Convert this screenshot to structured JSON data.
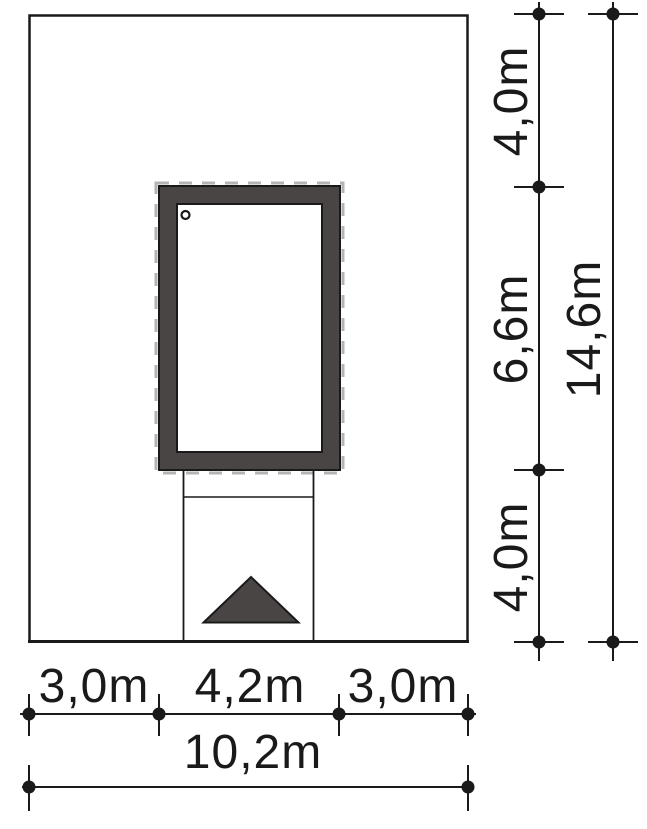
{
  "drawing_type": "site-plan dimension drawing",
  "colors": {
    "wall_fill": "#4a4545",
    "dash_outline": "#b4b4b4",
    "line": "#1a1a1a",
    "background": "#ffffff"
  },
  "dimensions": {
    "vertical": {
      "segments": [
        "4,0m",
        "6,6m",
        "4,0m"
      ],
      "total": "14,6m"
    },
    "horizontal": {
      "segments": [
        "3,0m",
        "4,2m",
        "3,0m"
      ],
      "total": "10,2m"
    }
  }
}
